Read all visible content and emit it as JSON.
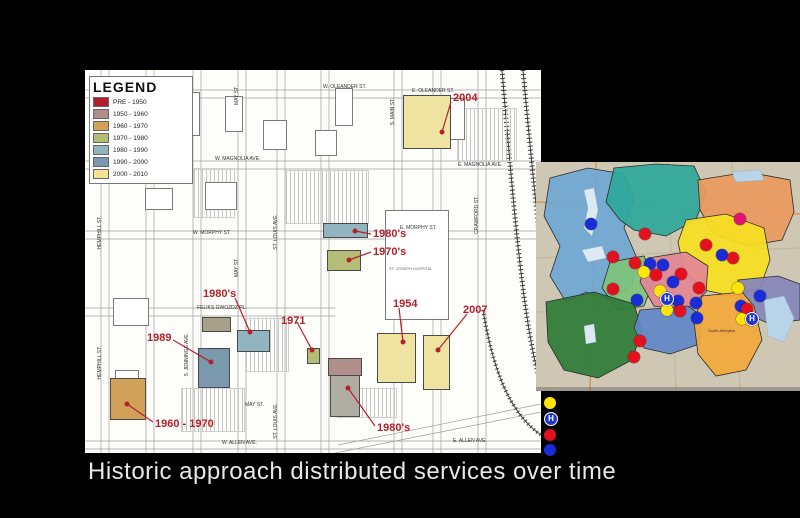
{
  "slide": {
    "caption": "Historic approach distributed services over time"
  },
  "campus_map": {
    "legend": {
      "title": "LEGEND",
      "entries": [
        {
          "label": "PRE - 1950",
          "color": "#b01f30"
        },
        {
          "label": "1950 - 1960",
          "color": "#b08e8a"
        },
        {
          "label": "1960 - 1970",
          "color": "#d2a159"
        },
        {
          "label": "1970 - 1980",
          "color": "#b3bd75"
        },
        {
          "label": "1980 - 1990",
          "color": "#92b4c1"
        },
        {
          "label": "1990 - 2000",
          "color": "#7b99ad"
        },
        {
          "label": "2000 - 2010",
          "color": "#f2e395"
        }
      ]
    },
    "street_labels": [
      {
        "text": "W. OLEANDER ST.",
        "x": 238,
        "y": 14,
        "v": false
      },
      {
        "text": "E. OLEANDER ST.",
        "x": 327,
        "y": 18,
        "v": false
      },
      {
        "text": "W. MAGNOLIA AVE.",
        "x": 130,
        "y": 86,
        "v": false
      },
      {
        "text": "E. MAGNOLIA AVE.",
        "x": 373,
        "y": 92,
        "v": false
      },
      {
        "text": "W. MORPHY ST.",
        "x": 108,
        "y": 160,
        "v": false
      },
      {
        "text": "E. MORPHY ST.",
        "x": 315,
        "y": 155,
        "v": false
      },
      {
        "text": "FELIKS GWOZDZ PL.",
        "x": 112,
        "y": 235,
        "v": false
      },
      {
        "text": "MAY ST.",
        "x": 160,
        "y": 332,
        "v": false
      },
      {
        "text": "W. ALLEN AVE.",
        "x": 137,
        "y": 370,
        "v": false
      },
      {
        "text": "E. ALLEN AVE.",
        "x": 368,
        "y": 368,
        "v": false
      },
      {
        "text": "HEMPHILL ST.",
        "x": 12,
        "y": 146,
        "v": true
      },
      {
        "text": "HEMPHILL ST.",
        "x": 12,
        "y": 276,
        "v": true
      },
      {
        "text": "GRAND AVE.",
        "x": 57,
        "y": 14,
        "v": true
      },
      {
        "text": "S. JENNINGS AVE.",
        "x": 104,
        "y": 12,
        "v": true
      },
      {
        "text": "S. JENNINGS AVE.",
        "x": 99,
        "y": 263,
        "v": true
      },
      {
        "text": "MAY ST.",
        "x": 149,
        "y": 16,
        "v": true
      },
      {
        "text": "MAY ST.",
        "x": 149,
        "y": 188,
        "v": true
      },
      {
        "text": "ST. LOUIS AVE.",
        "x": 188,
        "y": 144,
        "v": true
      },
      {
        "text": "ST. LOUIS AVE.",
        "x": 188,
        "y": 333,
        "v": true
      },
      {
        "text": "S. MAIN ST.",
        "x": 305,
        "y": 28,
        "v": true
      },
      {
        "text": "CRAWFORD ST.",
        "x": 389,
        "y": 126,
        "v": true
      }
    ],
    "building_labels": [
      {
        "text": "ST. JOSEPH HOSPITAL",
        "x": 304,
        "y": 196
      }
    ],
    "parking": [
      {
        "x": 200,
        "y": 100,
        "w": 82,
        "h": 52
      },
      {
        "x": 372,
        "y": 38,
        "w": 58,
        "h": 52
      },
      {
        "x": 108,
        "y": 98,
        "w": 40,
        "h": 48
      },
      {
        "x": 96,
        "y": 318,
        "w": 62,
        "h": 42
      },
      {
        "x": 160,
        "y": 248,
        "w": 42,
        "h": 52
      },
      {
        "x": 252,
        "y": 318,
        "w": 58,
        "h": 28
      }
    ],
    "outline_buildings": [
      {
        "name": "building-outline",
        "x": 95,
        "y": 22,
        "w": 18,
        "h": 42
      },
      {
        "name": "building-outline",
        "x": 140,
        "y": 26,
        "w": 16,
        "h": 34
      },
      {
        "name": "building-outline",
        "x": 250,
        "y": 18,
        "w": 16,
        "h": 36
      },
      {
        "name": "building-outline",
        "x": 178,
        "y": 50,
        "w": 22,
        "h": 28
      },
      {
        "name": "building-outline",
        "x": 60,
        "y": 118,
        "w": 26,
        "h": 20
      },
      {
        "name": "building-outline",
        "x": 120,
        "y": 112,
        "w": 30,
        "h": 26
      },
      {
        "name": "building-outline",
        "x": 230,
        "y": 60,
        "w": 20,
        "h": 24
      },
      {
        "name": "building-outline",
        "x": 28,
        "y": 228,
        "w": 34,
        "h": 26
      },
      {
        "name": "building-outline",
        "x": 30,
        "y": 300,
        "w": 22,
        "h": 18
      },
      {
        "name": "st-joseph-hospital-outline",
        "x": 300,
        "y": 140,
        "w": 62,
        "h": 108
      },
      {
        "name": "building-outline",
        "x": 352,
        "y": 28,
        "w": 26,
        "h": 40
      }
    ],
    "buildings": [
      {
        "name": "building-2004",
        "color": "#efe3a2",
        "x": 318,
        "y": 25,
        "w": 46,
        "h": 52
      },
      {
        "name": "building-1980s-north",
        "color": "#92b4c1",
        "x": 238,
        "y": 153,
        "w": 43,
        "h": 13
      },
      {
        "name": "building-1970s",
        "color": "#b3bd75",
        "x": 242,
        "y": 180,
        "w": 32,
        "h": 19
      },
      {
        "name": "building-feliks",
        "color": "#a9a089",
        "x": 117,
        "y": 247,
        "w": 27,
        "h": 13
      },
      {
        "name": "building-1980s-west",
        "color": "#92b4c1",
        "x": 152,
        "y": 260,
        "w": 31,
        "h": 20
      },
      {
        "name": "building-1989",
        "color": "#7b99ad",
        "x": 113,
        "y": 278,
        "w": 30,
        "h": 38
      },
      {
        "name": "building-olive-small",
        "color": "#b3bd75",
        "x": 222,
        "y": 278,
        "w": 11,
        "h": 14
      },
      {
        "name": "building-1960-1970",
        "color": "#d2a159",
        "x": 25,
        "y": 308,
        "w": 34,
        "h": 40
      },
      {
        "name": "building-mauve",
        "color": "#b08e8a",
        "x": 243,
        "y": 288,
        "w": 32,
        "h": 16
      },
      {
        "name": "building-1980s-south",
        "color": "#b0aea3",
        "x": 245,
        "y": 305,
        "w": 28,
        "h": 40
      },
      {
        "name": "building-1954",
        "color": "#efe3a2",
        "x": 292,
        "y": 263,
        "w": 37,
        "h": 48
      },
      {
        "name": "building-2007",
        "color": "#efe3a2",
        "x": 338,
        "y": 265,
        "w": 25,
        "h": 53
      }
    ],
    "annotations": [
      {
        "label": "2004",
        "lx": 368,
        "ly": 22,
        "x1": 366,
        "y1": 32,
        "x2": 357,
        "y2": 62
      },
      {
        "label": "1980's",
        "lx": 288,
        "ly": 158,
        "x1": 286,
        "y1": 164,
        "x2": 270,
        "y2": 161
      },
      {
        "label": "1970's",
        "lx": 288,
        "ly": 176,
        "x1": 286,
        "y1": 182,
        "x2": 264,
        "y2": 190
      },
      {
        "label": "1980's",
        "lx": 118,
        "ly": 218,
        "x1": 150,
        "y1": 228,
        "x2": 165,
        "y2": 262
      },
      {
        "label": "1971",
        "lx": 196,
        "ly": 245,
        "x1": 212,
        "y1": 252,
        "x2": 227,
        "y2": 280
      },
      {
        "label": "1954",
        "lx": 308,
        "ly": 228,
        "x1": 314,
        "y1": 238,
        "x2": 318,
        "y2": 272
      },
      {
        "label": "2007",
        "lx": 378,
        "ly": 234,
        "x1": 382,
        "y1": 244,
        "x2": 353,
        "y2": 280
      },
      {
        "label": "1989",
        "lx": 62,
        "ly": 262,
        "x1": 88,
        "y1": 270,
        "x2": 126,
        "y2": 292
      },
      {
        "label": "1960 - 1970",
        "lx": 70,
        "ly": 348,
        "x1": 68,
        "y1": 352,
        "x2": 42,
        "y2": 334
      },
      {
        "label": "1980's",
        "lx": 292,
        "ly": 352,
        "x1": 290,
        "y1": 356,
        "x2": 263,
        "y2": 318
      }
    ],
    "annotation_color": "#b5202c"
  },
  "region_map": {
    "background": "#cdc7b4",
    "roads": [
      {
        "path": "M0,96 L264,86",
        "color": "#c2b99e"
      },
      {
        "path": "M0,150 L264,140",
        "color": "#c2b99e"
      },
      {
        "path": "M132,0 L140,229",
        "color": "#c2b99e"
      },
      {
        "path": "M196,0 L204,229",
        "color": "#c2b99e"
      },
      {
        "path": "M0,40 L264,52",
        "color": "#d88f4a"
      },
      {
        "path": "M60,0 L54,229",
        "color": "#d88f4a"
      }
    ],
    "regions": [
      {
        "name": "northwest-lakes-district",
        "color": "#6fa8d2",
        "path": "M14,16 L52,6 L88,12 L98,38 L88,66 L100,94 L96,124 L74,138 L50,130 L30,140 L14,114 L24,84 L8,54 Z"
      },
      {
        "name": "north-district",
        "color": "#2ea89b",
        "path": "M70,40 L78,6 L120,2 L158,4 L170,30 L160,58 L130,74 L98,68 L84,58 Z"
      },
      {
        "name": "northeast-district",
        "color": "#e99a5f",
        "path": "M162,18 L212,10 L254,18 L258,50 L246,78 L212,84 L178,72 L164,48 Z"
      },
      {
        "name": "east-district",
        "color": "#f6df20",
        "path": "M150,58 L190,52 L228,66 L234,98 L224,126 L196,134 L168,128 L148,108 L142,80 Z"
      },
      {
        "name": "far-east-district",
        "color": "#8587ba",
        "path": "M202,118 L242,114 L264,122 L264,158 L234,162 L206,150 Z"
      },
      {
        "name": "midwest-district",
        "color": "#7fc47c",
        "path": "M74,100 L108,94 L118,118 L108,144 L82,148 L66,126 Z"
      },
      {
        "name": "central-district",
        "color": "#e28795",
        "path": "M112,96 L150,90 L172,104 L170,130 L150,148 L118,144 L104,120 Z"
      },
      {
        "name": "southwest-district",
        "color": "#2f7d39",
        "path": "M10,140 L58,130 L98,142 L106,168 L96,198 L62,216 L28,208 L12,180 Z"
      },
      {
        "name": "south-district",
        "color": "#6188c8",
        "path": "M104,148 L152,144 L166,154 L164,182 L134,192 L108,186 L98,166 Z"
      },
      {
        "name": "southeast-district",
        "color": "#f2a93c",
        "path": "M166,134 L206,130 L218,144 L226,178 L210,208 L180,214 L162,192 L158,160 Z"
      }
    ],
    "lakes": [
      {
        "path": "M48,28 L58,26 L62,48 L56,74 L48,66 L52,46 Z",
        "color": "#ddeaf3"
      },
      {
        "path": "M46,88 L66,84 L70,96 L52,100 Z",
        "color": "#ddeaf3"
      },
      {
        "path": "M48,164 L58,162 L60,180 L50,182 Z",
        "color": "#dce9f2"
      },
      {
        "path": "M228,138 L248,134 L258,156 L248,180 L232,174 Z",
        "color": "#b8d4e8"
      },
      {
        "path": "M196,10 L224,8 L228,18 L200,20 Z",
        "color": "#b8d4e8"
      }
    ],
    "labels": [
      {
        "text": "South Arlington",
        "x": 172,
        "y": 166
      }
    ],
    "markers": [
      {
        "t": "magenta",
        "x": 204,
        "y": 57
      },
      {
        "t": "blue",
        "x": 55,
        "y": 62
      },
      {
        "t": "red",
        "x": 109,
        "y": 72
      },
      {
        "t": "red",
        "x": 170,
        "y": 83
      },
      {
        "t": "blue",
        "x": 186,
        "y": 93
      },
      {
        "t": "red",
        "x": 197,
        "y": 96
      },
      {
        "t": "red",
        "x": 77,
        "y": 95
      },
      {
        "t": "red",
        "x": 99,
        "y": 101
      },
      {
        "t": "blue",
        "x": 114,
        "y": 102
      },
      {
        "t": "blue",
        "x": 127,
        "y": 103
      },
      {
        "t": "yellow",
        "x": 108,
        "y": 110
      },
      {
        "t": "red",
        "x": 120,
        "y": 113
      },
      {
        "t": "red",
        "x": 145,
        "y": 112
      },
      {
        "t": "blue",
        "x": 137,
        "y": 120
      },
      {
        "t": "red",
        "x": 163,
        "y": 126
      },
      {
        "t": "red",
        "x": 77,
        "y": 127
      },
      {
        "t": "yellow",
        "x": 124,
        "y": 129
      },
      {
        "t": "yellow",
        "x": 202,
        "y": 126
      },
      {
        "t": "blue",
        "x": 224,
        "y": 134
      },
      {
        "t": "hospital",
        "x": 131,
        "y": 137
      },
      {
        "t": "blue",
        "x": 142,
        "y": 139
      },
      {
        "t": "blue",
        "x": 101,
        "y": 138
      },
      {
        "t": "blue",
        "x": 160,
        "y": 141
      },
      {
        "t": "blue",
        "x": 205,
        "y": 144
      },
      {
        "t": "red",
        "x": 211,
        "y": 147
      },
      {
        "t": "yellow",
        "x": 131,
        "y": 148
      },
      {
        "t": "red",
        "x": 144,
        "y": 149
      },
      {
        "t": "blue",
        "x": 161,
        "y": 156
      },
      {
        "t": "yellow",
        "x": 206,
        "y": 157
      },
      {
        "t": "hospital",
        "x": 216,
        "y": 157
      },
      {
        "t": "red",
        "x": 104,
        "y": 179
      },
      {
        "t": "red",
        "x": 98,
        "y": 195
      }
    ]
  },
  "marker_colors": {
    "yellow": "#ffe40a",
    "red": "#e5101e",
    "blue": "#1a2cd8",
    "magenta": "#e0136e",
    "hospital": "#2238c8"
  },
  "right_legend": {
    "items": [
      {
        "t": "yellow"
      },
      {
        "t": "hospital"
      },
      {
        "t": "red"
      },
      {
        "t": "blue"
      }
    ]
  }
}
